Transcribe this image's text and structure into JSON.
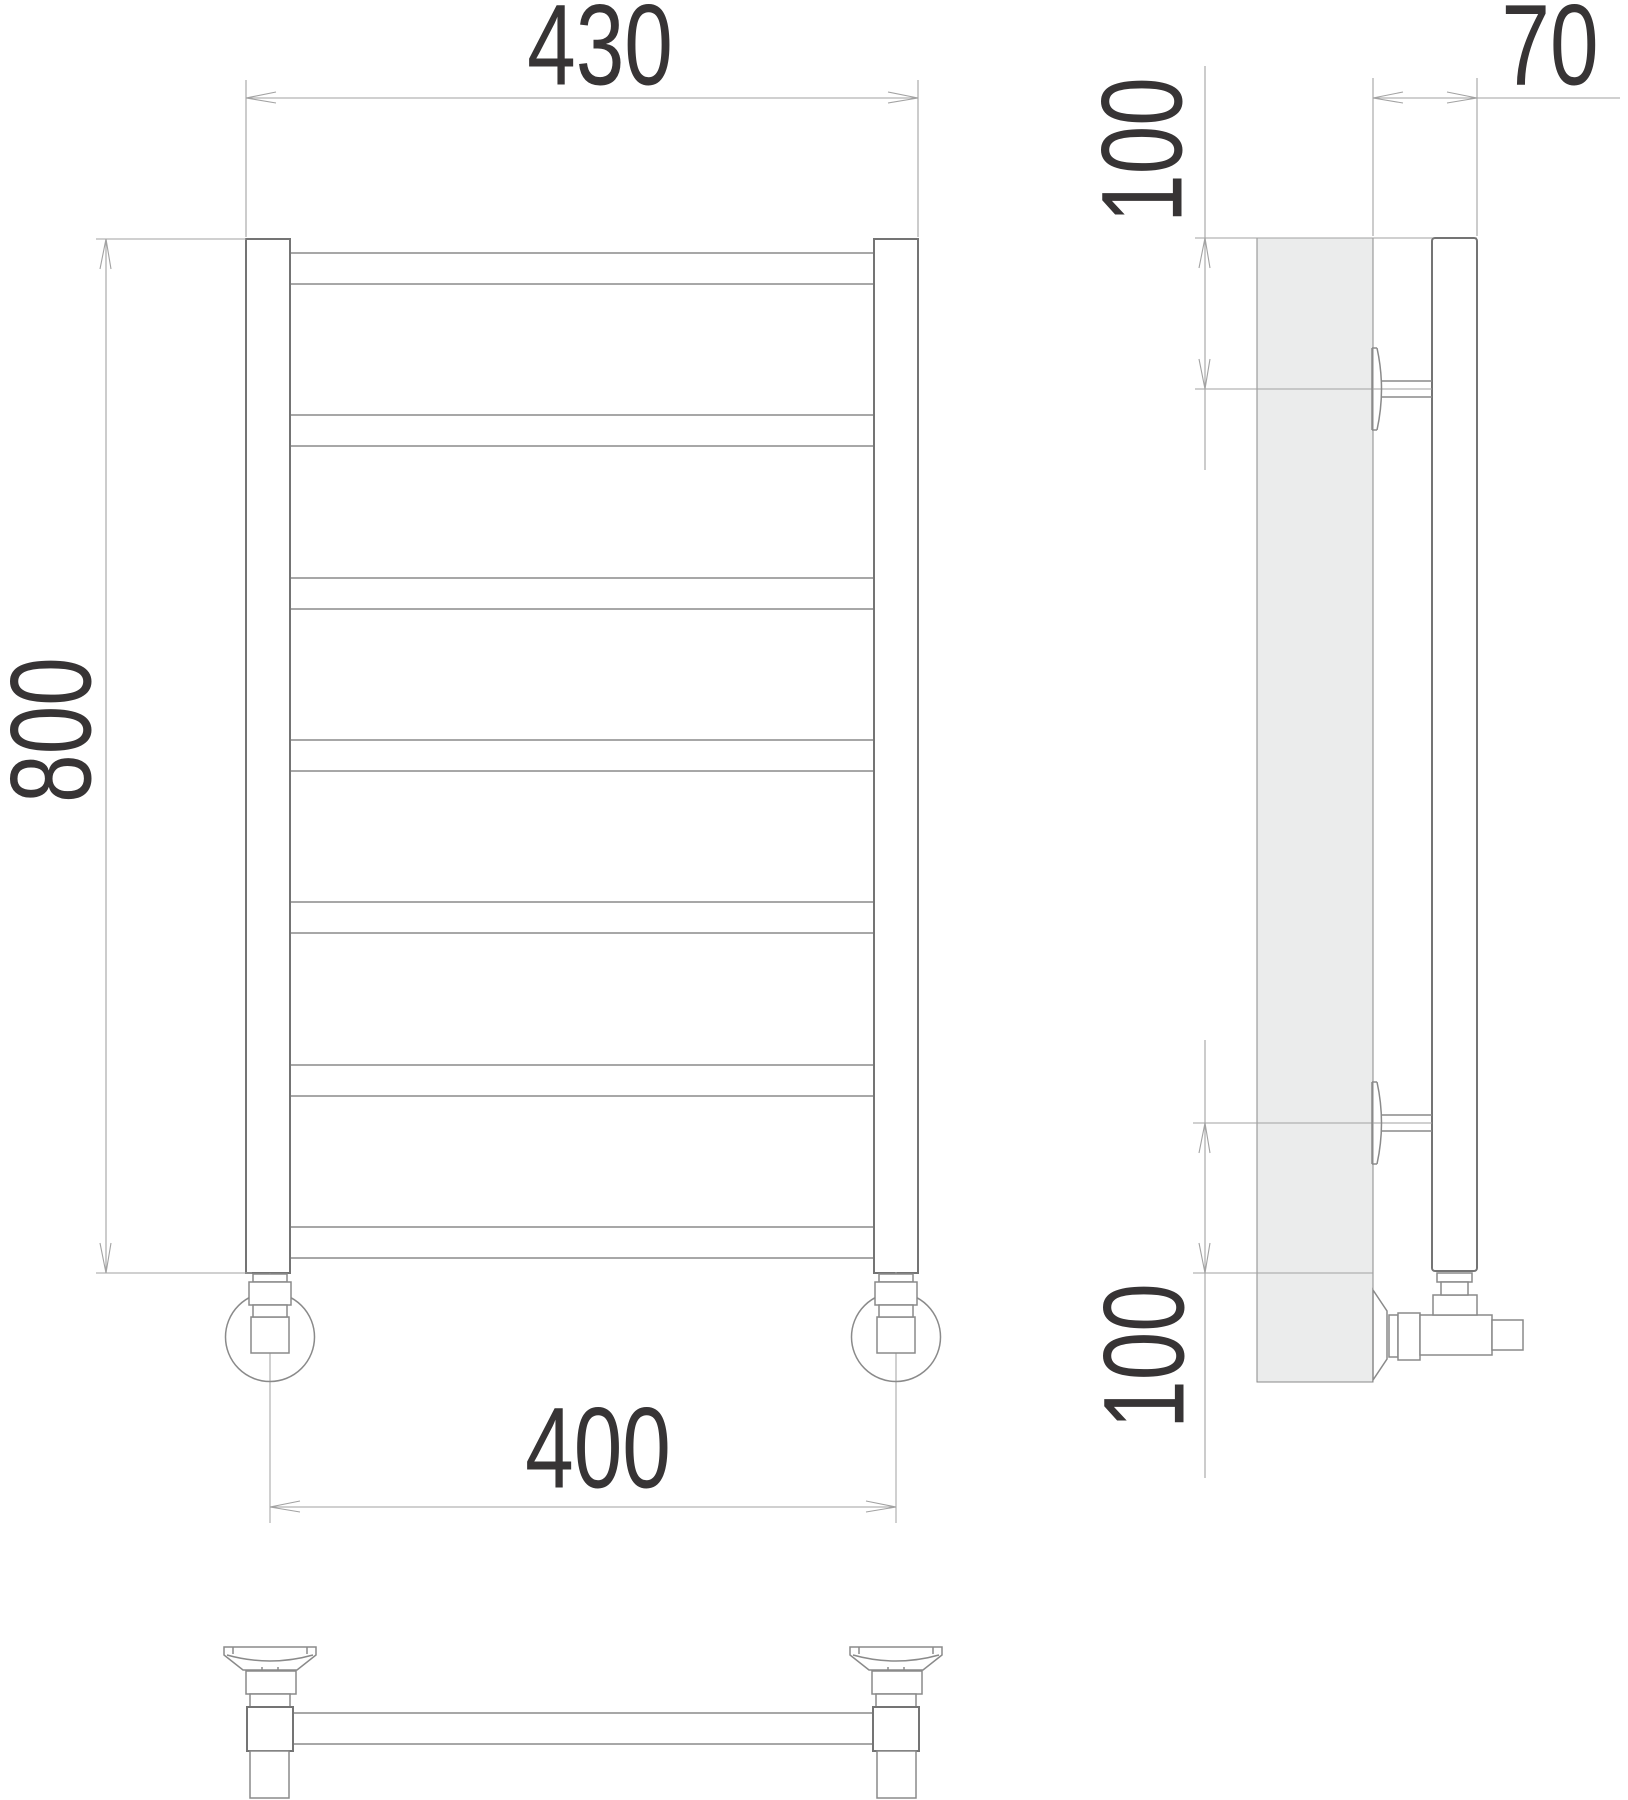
{
  "drawing": {
    "type": "technical-drawing",
    "subject": "ladder towel rail radiator, three orthographic views",
    "views": {
      "front": {
        "label": "front-view",
        "bar_count": 7,
        "dimensions": {
          "overall_width": "430",
          "overall_height": "800",
          "connection_spacing": "400"
        }
      },
      "side": {
        "label": "side-view",
        "dimensions": {
          "wall_offset": "70",
          "top_bracket_offset": "100",
          "bottom_bracket_offset": "100"
        }
      },
      "bottom": {
        "label": "bottom-view"
      }
    }
  },
  "colors": {
    "background": "#ffffff",
    "object_line": "#8a8a8a",
    "object_line_dark": "#747474",
    "dimension_line": "#a2a2a2",
    "wall_fill": "#ebecec",
    "text": "#373435"
  }
}
